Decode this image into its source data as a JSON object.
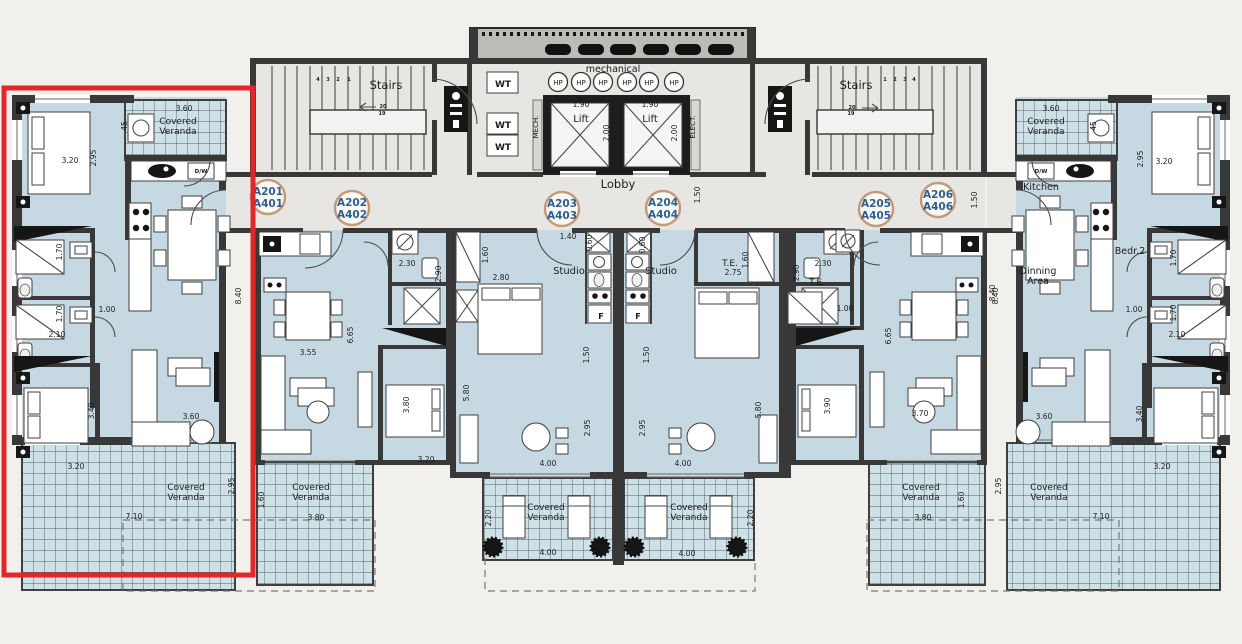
{
  "badges": [
    {
      "l1": "A201",
      "l2": "A401"
    },
    {
      "l1": "A202",
      "l2": "A402"
    },
    {
      "l1": "A203",
      "l2": "A403"
    },
    {
      "l1": "A204",
      "l2": "A404"
    },
    {
      "l1": "A205",
      "l2": "A405"
    },
    {
      "l1": "A206",
      "l2": "A406"
    }
  ],
  "labels": {
    "rooms": [
      "Covered",
      "Veranda",
      "Covered",
      "Veranda",
      "Covered",
      "Veranda",
      "Covered",
      "Veranda",
      "Covered",
      "Veranda",
      "Covered",
      "Veranda",
      "Covered",
      "Veranda",
      "Covered",
      "Veranda",
      "Stairs",
      "Stairs",
      "mechanical",
      "Lift",
      "Lift",
      "Lobby",
      "Studio",
      "Studio",
      "Kitchen",
      "Dinning",
      "Area",
      "Bedr.2",
      "T.E.",
      "T.E.",
      "F",
      "F",
      "D/W",
      "D/W",
      "MECH.",
      "ELECT.",
      "WT",
      "WT",
      "WT",
      "HP",
      "HP",
      "HP",
      "HP",
      "HP",
      "HP"
    ],
    "dims": [
      "3.60",
      "45",
      "3.20",
      "2.95",
      "1.70",
      "1.70",
      "2.10",
      "1.00",
      "8.40",
      "3.40",
      "3.20",
      "3.60",
      "2.95",
      "7.10",
      "2.30",
      "2.90",
      "1.60",
      "2.80",
      "3.55",
      "6.65",
      "3.80",
      "3.20",
      "3.80",
      "1.60",
      "1.40",
      "0.60",
      "0.60",
      "1.50",
      "1.50",
      "1.50",
      "5.80",
      "5.80",
      "2.95",
      "2.95",
      "4.00",
      "4.00",
      "4.00",
      "4.00",
      "2.20",
      "2.20",
      "2.75",
      "1.60",
      "2.30",
      "2.90",
      "1.00",
      "3.90",
      "6.65",
      "3.70",
      "8.40",
      "3.80",
      "1.60",
      "3.60",
      "45",
      "3.20",
      "2.95",
      "1.70",
      "1.70",
      "2.10",
      "1.00",
      "8.40",
      "3.40",
      "3.20",
      "3.60",
      "2.95",
      "7.10",
      "1.90",
      "1.90",
      "2.00",
      "2.00",
      "1.50"
    ],
    "small": [
      "4",
      "3",
      "2",
      "1",
      "20",
      "19",
      "1",
      "2",
      "3",
      "4",
      "20",
      "19"
    ]
  },
  "colors": {
    "highlight_red": "#e2262a",
    "unit_floor": "#c6d9e2",
    "veranda_floor": "#cfe0e6",
    "core_floor": "#e7e6e3",
    "wall": "#383838",
    "badge_ring": "#c49a7c",
    "badge_text": "#2d5e8e"
  }
}
